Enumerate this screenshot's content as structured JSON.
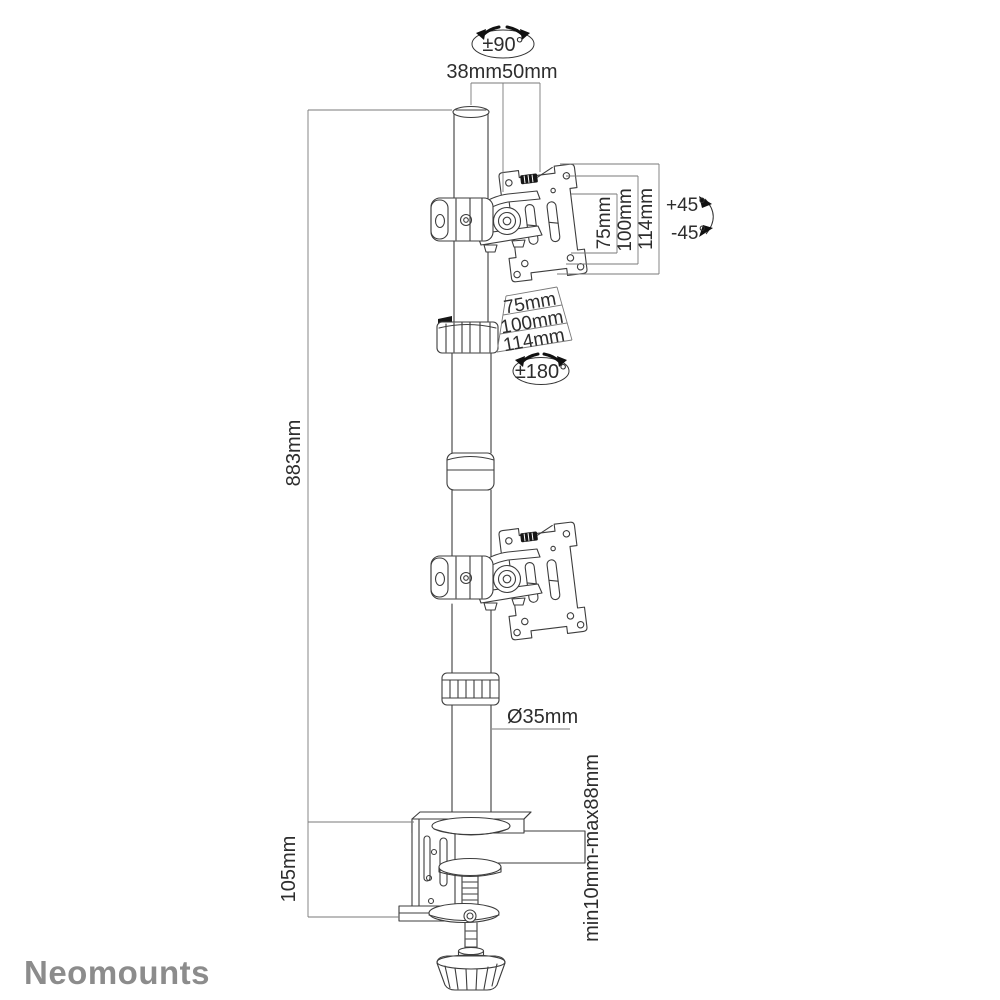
{
  "product_diagram": {
    "brand_logo": "Neomounts",
    "annotations": {
      "pole_rotation": "±90°",
      "top_width_inner": "38mm",
      "top_width_outer": "50mm",
      "tilt_up": "+45°",
      "tilt_down": "-45°",
      "vesa_vertical": {
        "v75": "75mm",
        "v100": "100mm",
        "v114": "114mm"
      },
      "vesa_horizontal": {
        "h75": "75mm",
        "h100": "100mm",
        "h114": "114mm"
      },
      "plate_rotation": "±180°",
      "pole_height": "883mm",
      "pole_diameter": "Ø35mm",
      "clamp_bracket_height": "105mm",
      "desk_thickness_range": "min10mm-max88mm"
    },
    "colors": {
      "line": "#3d3d3d",
      "dimension": "#7a7a7a",
      "text": "#2d2d2d",
      "brand": "#8c8c8c"
    }
  }
}
